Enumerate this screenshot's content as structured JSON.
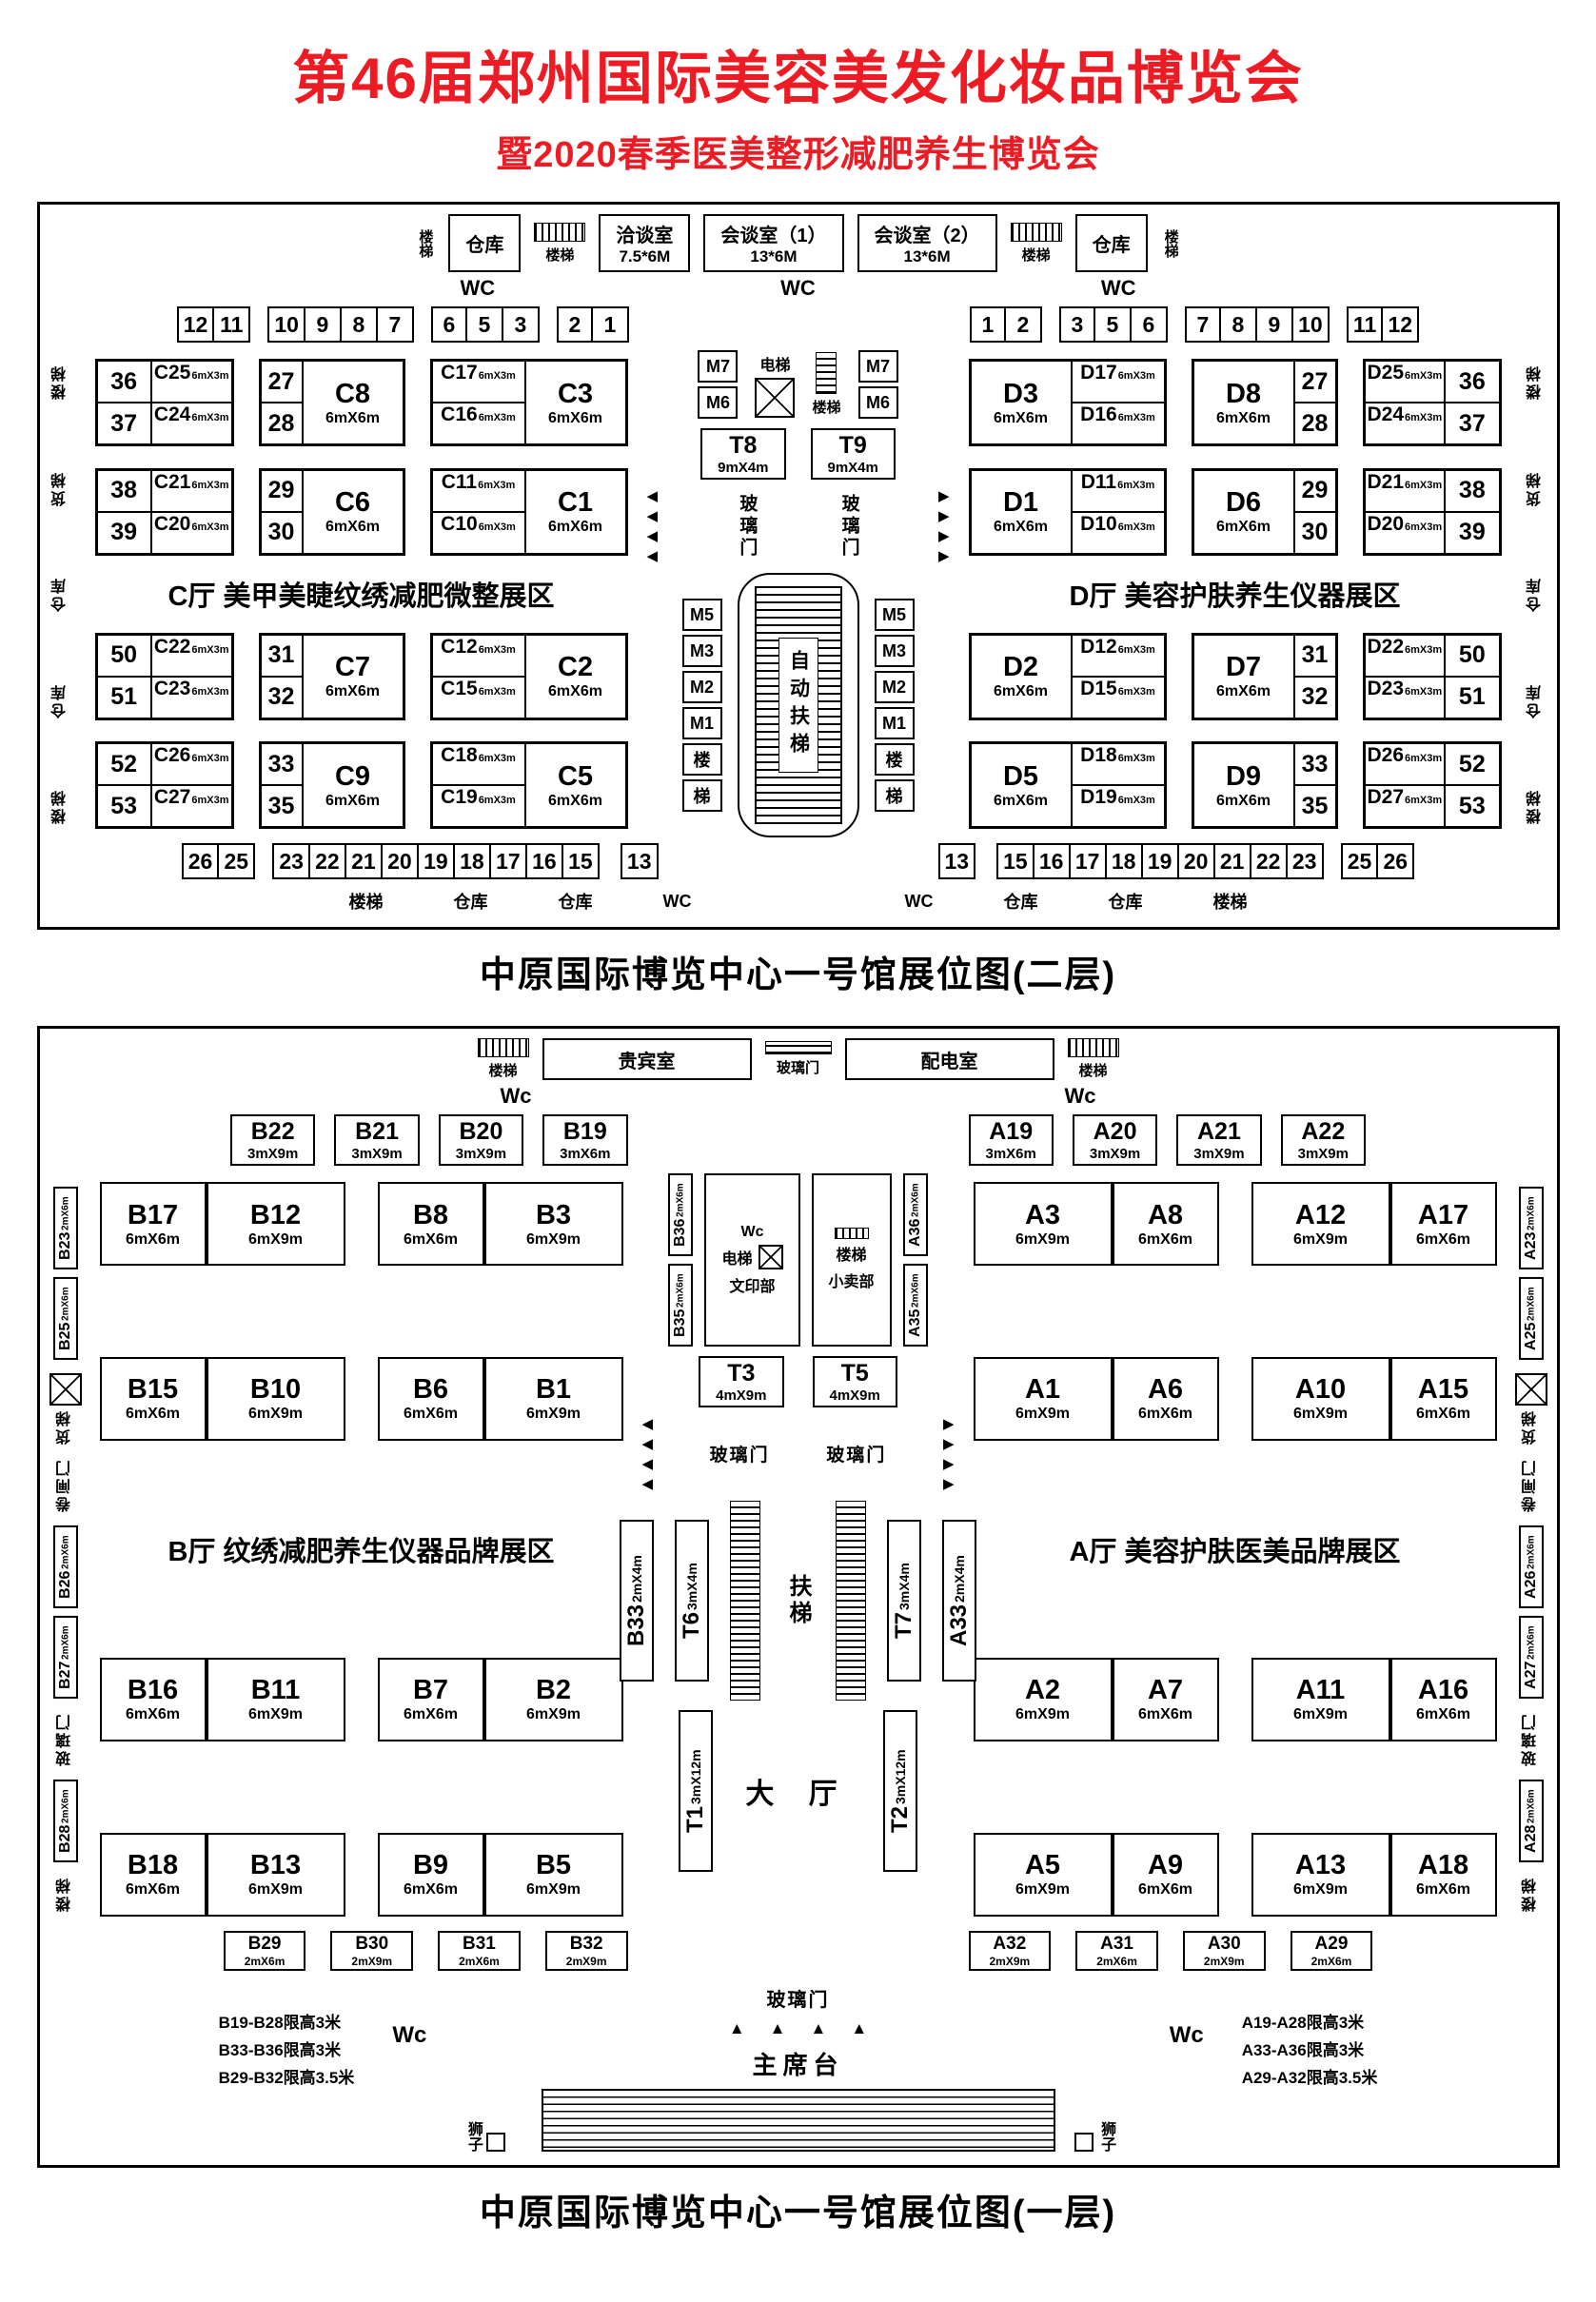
{
  "title": {
    "line1": "第46届郑州国际美容美发化妆品博览会",
    "line2": "暨2020春季医美整形减肥养生博览会",
    "color": "#ed1c24"
  },
  "floor2": {
    "caption": "中原国际博览中心一号馆展位图(二层)",
    "top": {
      "stairs": "楼梯",
      "warehouse": "仓库",
      "wc": "WC",
      "meeting_rooms": [
        {
          "name": "洽谈室",
          "size": "7.5*6M"
        },
        {
          "name": "会谈室（1）",
          "size": "13*6M"
        },
        {
          "name": "会谈室（2）",
          "size": "13*6M"
        }
      ]
    },
    "strip_top_left": [
      [
        "12",
        "11"
      ],
      [
        "10",
        "9",
        "8",
        "7"
      ],
      [
        "6",
        "5",
        "3"
      ],
      [
        "2",
        "1"
      ]
    ],
    "strip_top_right": [
      [
        "1",
        "2"
      ],
      [
        "3",
        "5",
        "6"
      ],
      [
        "7",
        "8",
        "9",
        "10"
      ],
      [
        "11",
        "12"
      ]
    ],
    "strip_bottom_left": [
      [
        "26",
        "25"
      ],
      [
        "23",
        "22",
        "21",
        "20",
        "19",
        "18",
        "17",
        "16",
        "15"
      ]
    ],
    "strip_bottom_right": [
      [
        "15",
        "16",
        "17",
        "18",
        "19",
        "20",
        "21",
        "22",
        "23"
      ],
      [
        "25",
        "26"
      ]
    ],
    "thirteen": "13",
    "left_edge": [
      "楼梯",
      "货梯",
      "仓库",
      "仓库",
      "楼梯"
    ],
    "right_edge": [
      "楼梯",
      "货梯",
      "仓库",
      "仓库",
      "楼梯"
    ],
    "c_hall": {
      "label": "C厅  美甲美睫纹绣减肥微整展区",
      "rows": [
        [
          {
            "nc": [
              [
                "36",
                "C25",
                "6mX3m"
              ],
              [
                "37",
                "C24",
                "6mX3m"
              ]
            ]
          },
          {
            "nums": [
              "27",
              "28"
            ],
            "big": [
              "C8",
              "6mX6m"
            ]
          },
          {
            "codes": [
              [
                "C17",
                "6mX3m"
              ],
              [
                "C16",
                "6mX3m"
              ]
            ],
            "big": [
              "C3",
              "6mX6m"
            ]
          }
        ],
        [
          {
            "nc": [
              [
                "38",
                "C21",
                "6mX3m"
              ],
              [
                "39",
                "C20",
                "6mX3m"
              ]
            ]
          },
          {
            "nums": [
              "29",
              "30"
            ],
            "big": [
              "C6",
              "6mX6m"
            ]
          },
          {
            "codes": [
              [
                "C11",
                "6mX3m"
              ],
              [
                "C10",
                "6mX3m"
              ]
            ],
            "big": [
              "C1",
              "6mX6m"
            ]
          }
        ],
        [
          {
            "nc": [
              [
                "50",
                "C22",
                "6mX3m"
              ],
              [
                "51",
                "C23",
                "6mX3m"
              ]
            ]
          },
          {
            "nums": [
              "31",
              "32"
            ],
            "big": [
              "C7",
              "6mX6m"
            ]
          },
          {
            "codes": [
              [
                "C12",
                "6mX3m"
              ],
              [
                "C15",
                "6mX3m"
              ]
            ],
            "big": [
              "C2",
              "6mX6m"
            ]
          }
        ],
        [
          {
            "nc": [
              [
                "52",
                "C26",
                "6mX3m"
              ],
              [
                "53",
                "C27",
                "6mX3m"
              ]
            ]
          },
          {
            "nums": [
              "33",
              "35"
            ],
            "big": [
              "C9",
              "6mX6m"
            ]
          },
          {
            "codes": [
              [
                "C18",
                "6mX3m"
              ],
              [
                "C19",
                "6mX3m"
              ]
            ],
            "big": [
              "C5",
              "6mX6m"
            ]
          }
        ]
      ]
    },
    "d_hall": {
      "label": "D厅  美容护肤养生仪器展区",
      "rows": [
        [
          {
            "bigFirst": true,
            "big": [
              "D3",
              "6mX6m"
            ],
            "codes": [
              [
                "D17",
                "6mX3m"
              ],
              [
                "D16",
                "6mX3m"
              ]
            ]
          },
          {
            "bigFirst": true,
            "big": [
              "D8",
              "6mX6m"
            ],
            "nums": [
              "27",
              "28"
            ]
          },
          {
            "cn": [
              [
                "D25",
                "6mX3m",
                "36"
              ],
              [
                "D24",
                "6mX3m",
                "37"
              ]
            ]
          }
        ],
        [
          {
            "bigFirst": true,
            "big": [
              "D1",
              "6mX6m"
            ],
            "codes": [
              [
                "D11",
                "6mX3m"
              ],
              [
                "D10",
                "6mX3m"
              ]
            ]
          },
          {
            "bigFirst": true,
            "big": [
              "D6",
              "6mX6m"
            ],
            "nums": [
              "29",
              "30"
            ]
          },
          {
            "cn": [
              [
                "D21",
                "6mX3m",
                "38"
              ],
              [
                "D20",
                "6mX3m",
                "39"
              ]
            ]
          }
        ],
        [
          {
            "bigFirst": true,
            "big": [
              "D2",
              "6mX6m"
            ],
            "codes": [
              [
                "D12",
                "6mX3m"
              ],
              [
                "D15",
                "6mX3m"
              ]
            ]
          },
          {
            "bigFirst": true,
            "big": [
              "D7",
              "6mX6m"
            ],
            "nums": [
              "31",
              "32"
            ]
          },
          {
            "cn": [
              [
                "D22",
                "6mX3m",
                "50"
              ],
              [
                "D23",
                "6mX3m",
                "51"
              ]
            ]
          }
        ],
        [
          {
            "bigFirst": true,
            "big": [
              "D5",
              "6mX6m"
            ],
            "codes": [
              [
                "D18",
                "6mX3m"
              ],
              [
                "D19",
                "6mX3m"
              ]
            ]
          },
          {
            "bigFirst": true,
            "big": [
              "D9",
              "6mX6m"
            ],
            "nums": [
              "33",
              "35"
            ]
          },
          {
            "cn": [
              [
                "D26",
                "6mX3m",
                "52"
              ],
              [
                "D27",
                "6mX3m",
                "53"
              ]
            ]
          }
        ]
      ]
    },
    "center": {
      "m_top": [
        "M7",
        "M6"
      ],
      "elevator": "电梯",
      "stairs": "楼梯",
      "glass_door": "玻璃门",
      "escalator": "自动扶梯",
      "m_col": [
        "M5",
        "M3",
        "M2",
        "M1",
        "楼",
        "梯"
      ],
      "t8": [
        [
          "T8",
          "9mX4m"
        ]
      ],
      "t9": [
        [
          "T9",
          "9mX4m"
        ]
      ]
    },
    "bottom_band": [
      "楼梯",
      "仓库",
      "仓库",
      "WC",
      "WC",
      "仓库",
      "仓库",
      "楼梯"
    ]
  },
  "floor1": {
    "caption": "中原国际博览中心一号馆展位图(一层)",
    "top": {
      "stairs": "楼梯",
      "vip": "贵宾室",
      "glass": "玻璃门",
      "power": "配电室",
      "wc": "Wc"
    },
    "b_top": [
      [
        "B22",
        "3mX9m"
      ],
      [
        "B21",
        "3mX9m"
      ],
      [
        "B20",
        "3mX9m"
      ],
      [
        "B19",
        "3mX6m"
      ]
    ],
    "a_top": [
      [
        "A19",
        "3mX6m"
      ],
      [
        "A20",
        "3mX9m"
      ],
      [
        "A21",
        "3mX9m"
      ],
      [
        "A22",
        "3mX9m"
      ]
    ],
    "left_edge_top": [
      [
        "B23",
        "2mX6m"
      ],
      [
        "B25",
        "2mX6m"
      ]
    ],
    "left_edge_mid": [
      [
        "B26",
        "2mX6m"
      ],
      [
        "B27",
        "2mX6m"
      ]
    ],
    "left_edge_bot": [
      [
        "B28",
        "2mX6m"
      ]
    ],
    "right_edge_top": [
      [
        "A23",
        "2mX6m"
      ],
      [
        "A25",
        "2mX6m"
      ]
    ],
    "right_edge_mid": [
      [
        "A26",
        "2mX6m"
      ],
      [
        "A27",
        "2mX6m"
      ]
    ],
    "right_edge_bot": [
      [
        "A28",
        "2mX6m"
      ]
    ],
    "edge_labels": {
      "freight": "货梯",
      "roller": "卷闸门",
      "glass": "玻璃门",
      "stairs": "楼梯"
    },
    "b_hall": {
      "label": "B厅  纹绣减肥养生仪器品牌展区",
      "rows": [
        [
          [
            "B17",
            "6mX6m"
          ],
          [
            "B12",
            "6mX9m"
          ],
          [
            "B8",
            "6mX6m"
          ],
          [
            "B3",
            "6mX9m"
          ]
        ],
        [
          [
            "B15",
            "6mX6m"
          ],
          [
            "B10",
            "6mX9m"
          ],
          [
            "B6",
            "6mX6m"
          ],
          [
            "B1",
            "6mX9m"
          ]
        ],
        [
          [
            "B16",
            "6mX6m"
          ],
          [
            "B11",
            "6mX9m"
          ],
          [
            "B7",
            "6mX6m"
          ],
          [
            "B2",
            "6mX9m"
          ]
        ],
        [
          [
            "B18",
            "6mX6m"
          ],
          [
            "B13",
            "6mX9m"
          ],
          [
            "B9",
            "6mX6m"
          ],
          [
            "B5",
            "6mX9m"
          ]
        ]
      ],
      "bottom": [
        [
          "B29",
          "2mX6m"
        ],
        [
          "B30",
          "2mX9m"
        ],
        [
          "B31",
          "2mX6m"
        ],
        [
          "B32",
          "2mX9m"
        ]
      ],
      "notes": [
        "B19-B28限高3米",
        "B33-B36限高3米",
        "B29-B32限高3.5米"
      ]
    },
    "a_hall": {
      "label": "A厅  美容护肤医美品牌展区",
      "rows": [
        [
          [
            "A3",
            "6mX9m"
          ],
          [
            "A8",
            "6mX6m"
          ],
          [
            "A12",
            "6mX9m"
          ],
          [
            "A17",
            "6mX6m"
          ]
        ],
        [
          [
            "A1",
            "6mX9m"
          ],
          [
            "A6",
            "6mX6m"
          ],
          [
            "A10",
            "6mX9m"
          ],
          [
            "A15",
            "6mX6m"
          ]
        ],
        [
          [
            "A2",
            "6mX9m"
          ],
          [
            "A7",
            "6mX6m"
          ],
          [
            "A11",
            "6mX9m"
          ],
          [
            "A16",
            "6mX6m"
          ]
        ],
        [
          [
            "A5",
            "6mX9m"
          ],
          [
            "A9",
            "6mX6m"
          ],
          [
            "A13",
            "6mX9m"
          ],
          [
            "A18",
            "6mX6m"
          ]
        ]
      ],
      "bottom": [
        [
          "A32",
          "2mX9m"
        ],
        [
          "A31",
          "2mX6m"
        ],
        [
          "A30",
          "2mX9m"
        ],
        [
          "A29",
          "2mX6m"
        ]
      ],
      "notes": [
        "A19-A28限高3米",
        "A33-A36限高3米",
        "A29-A32限高3.5米"
      ]
    },
    "center": {
      "wc": "Wc",
      "elevator": "电梯",
      "print": "文印部",
      "stairs": "楼梯",
      "shop": "小卖部",
      "left_v": [
        [
          "B36",
          "2mX6m"
        ],
        [
          "B35",
          "2mX6m"
        ]
      ],
      "right_v": [
        [
          "A36",
          "2mX6m"
        ],
        [
          "A35",
          "2mX6m"
        ]
      ],
      "t3": [
        [
          "T3",
          "4mX9m"
        ]
      ],
      "t5": [
        [
          "T5",
          "4mX9m"
        ]
      ],
      "glass": "玻璃门",
      "escalator": "扶梯",
      "b33": [
        [
          "B33",
          "2mX4m"
        ]
      ],
      "t6": [
        [
          "T6",
          "3mX4m"
        ]
      ],
      "t7": [
        [
          "T7",
          "3mX4m"
        ]
      ],
      "a33": [
        [
          "A33",
          "2mX4m"
        ]
      ],
      "t1": [
        [
          "T1",
          "3mX12m"
        ]
      ],
      "t2": [
        [
          "T2",
          "3mX12m"
        ]
      ],
      "hall": "大 厅",
      "glass_bottom": "玻璃门",
      "stage": "主席台",
      "lion_left": "狮子",
      "lion_right": "狮子",
      "wc_left": "Wc",
      "wc_right": "Wc"
    }
  }
}
